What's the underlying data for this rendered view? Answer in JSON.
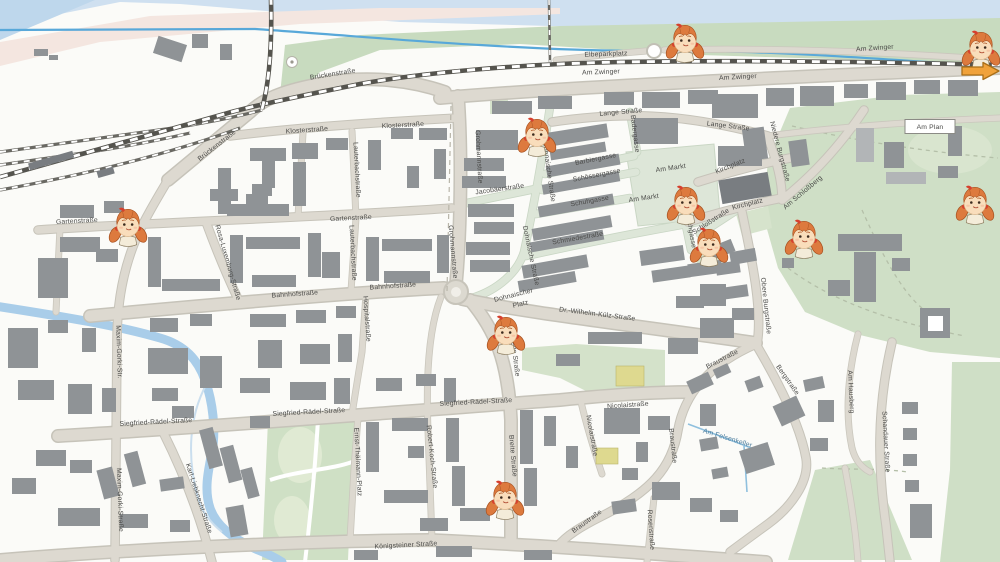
{
  "map": {
    "colors": {
      "building": "#8f9396",
      "road": "#ddd9d0",
      "pedestrian_zone": "#dde6d8",
      "park": "#cfdfc6",
      "riverbank_meadow": "#c8dbbf",
      "water_line": "#58a8d9",
      "river": "#a9cde9",
      "railway": "#55544e",
      "mascot_hair": "#dd7a3e",
      "mascot_ribbon": "#d6402e",
      "arrow": "#f0a23a",
      "label_text": "#4a4a48"
    },
    "street_labels": [
      {
        "t": "Brückenstraße",
        "x": 218,
        "y": 147,
        "r": -38
      },
      {
        "t": "Brückenstraße",
        "x": 333,
        "y": 76,
        "r": -9
      },
      {
        "t": "Klosterstraße",
        "x": 307,
        "y": 132,
        "r": -4
      },
      {
        "t": "Klosterstraße",
        "x": 403,
        "y": 127,
        "r": -3
      },
      {
        "t": "Elbeparkplatz",
        "x": 606,
        "y": 56,
        "r": -2
      },
      {
        "t": "Am Zwinger",
        "x": 601,
        "y": 74,
        "r": -2
      },
      {
        "t": "Am Zwinger",
        "x": 738,
        "y": 79,
        "r": -3
      },
      {
        "t": "Am Zwinger",
        "x": 875,
        "y": 50,
        "r": -4
      },
      {
        "t": "Lange Straße",
        "x": 621,
        "y": 114,
        "r": -5
      },
      {
        "t": "Lange Straße",
        "x": 728,
        "y": 128,
        "r": 7
      },
      {
        "t": "Am Plan",
        "x": 930,
        "y": 129,
        "r": 0,
        "b": 1
      },
      {
        "t": "Kirchplatz",
        "x": 731,
        "y": 168,
        "r": -22
      },
      {
        "t": "Kirchplatz",
        "x": 748,
        "y": 206,
        "r": -14
      },
      {
        "t": "Niedere Burgstraße",
        "x": 778,
        "y": 152,
        "r": 75
      },
      {
        "t": "Badergasse",
        "x": 633,
        "y": 134,
        "r": 83
      },
      {
        "t": "Barbiergasse",
        "x": 596,
        "y": 161,
        "r": -11
      },
      {
        "t": "Schössergasse",
        "x": 597,
        "y": 177,
        "r": -11
      },
      {
        "t": "Schuhgasse",
        "x": 590,
        "y": 203,
        "r": -10
      },
      {
        "t": "Am Markt",
        "x": 671,
        "y": 170,
        "r": -8
      },
      {
        "t": "Am Markt",
        "x": 644,
        "y": 200,
        "r": -8
      },
      {
        "t": "Jacobäerstraße",
        "x": 500,
        "y": 191,
        "r": -8
      },
      {
        "t": "Schmiedestraße",
        "x": 578,
        "y": 240,
        "r": -10
      },
      {
        "t": "Schloßstraße",
        "x": 712,
        "y": 223,
        "r": -33
      },
      {
        "t": "Kirchgasse",
        "x": 689,
        "y": 231,
        "r": 80
      },
      {
        "t": "Am Schloßberg",
        "x": 804,
        "y": 194,
        "r": -40
      },
      {
        "t": "Obere Burgstraße",
        "x": 764,
        "y": 306,
        "r": 84
      },
      {
        "t": "Dohnaische Straße",
        "x": 547,
        "y": 172,
        "r": 82
      },
      {
        "t": "Dohnaische Straße",
        "x": 529,
        "y": 256,
        "r": 78
      },
      {
        "t": "Grohmannstraße",
        "x": 477,
        "y": 157,
        "r": 87
      },
      {
        "t": "Grohmannstraße",
        "x": 451,
        "y": 252,
        "r": 85
      },
      {
        "t": "Gartenstraße",
        "x": 77,
        "y": 223,
        "r": -3
      },
      {
        "t": "Gartenstraße",
        "x": 351,
        "y": 220,
        "r": -3
      },
      {
        "t": "Lauterbachstraße",
        "x": 355,
        "y": 170,
        "r": 87
      },
      {
        "t": "Lauterbachstraße",
        "x": 351,
        "y": 253,
        "r": 87
      },
      {
        "t": "Rosa-Luxemburg-Straße",
        "x": 226,
        "y": 263,
        "r": 74
      },
      {
        "t": "Bahnhofstraße",
        "x": 295,
        "y": 296,
        "r": -4
      },
      {
        "t": "Bahnhofstraße",
        "x": 393,
        "y": 288,
        "r": -4
      },
      {
        "t": "Hospitalstraße",
        "x": 365,
        "y": 319,
        "r": 86
      },
      {
        "t": "Maxim-Gorki-Str.",
        "x": 117,
        "y": 352,
        "r": 88
      },
      {
        "t": "Maxim-Gorki-Straße",
        "x": 118,
        "y": 500,
        "r": 88
      },
      {
        "t": "Dohnaischer",
        "x": 514,
        "y": 297,
        "r": -14
      },
      {
        "t": "Platz",
        "x": 521,
        "y": 306,
        "r": -14
      },
      {
        "t": "Dr.-Wilhelm-Külz-Straße",
        "x": 597,
        "y": 316,
        "r": 7
      },
      {
        "t": "Breite Straße",
        "x": 513,
        "y": 356,
        "r": 83
      },
      {
        "t": "Breite Straße",
        "x": 511,
        "y": 456,
        "r": 85
      },
      {
        "t": "Siegfried-Rädel-Straße",
        "x": 156,
        "y": 424,
        "r": -3
      },
      {
        "t": "Siegfried-Rädel-Straße",
        "x": 309,
        "y": 414,
        "r": -3
      },
      {
        "t": "Siegfried-Rädel-Straße",
        "x": 476,
        "y": 404,
        "r": -3
      },
      {
        "t": "Nicolaistraße",
        "x": 628,
        "y": 407,
        "r": -4
      },
      {
        "t": "Nicolaistraße",
        "x": 590,
        "y": 436,
        "r": 80
      },
      {
        "t": "Robert-Koch-Straße",
        "x": 430,
        "y": 457,
        "r": 84
      },
      {
        "t": "Karl-Liebknecht-Straße",
        "x": 197,
        "y": 499,
        "r": 72
      },
      {
        "t": "Ernst-Thälmann-Platz",
        "x": 356,
        "y": 462,
        "r": 87
      },
      {
        "t": "Königsteiner Straße",
        "x": 406,
        "y": 547,
        "r": -3
      },
      {
        "t": "Braustraße",
        "x": 723,
        "y": 361,
        "r": -27
      },
      {
        "t": "Braustraße",
        "x": 671,
        "y": 446,
        "r": 84
      },
      {
        "t": "Braustraße",
        "x": 588,
        "y": 523,
        "r": -36
      },
      {
        "t": "Rosenstraße",
        "x": 649,
        "y": 530,
        "r": 86
      },
      {
        "t": "Bergstraße",
        "x": 786,
        "y": 381,
        "r": 55
      },
      {
        "t": "Am Hausberg",
        "x": 849,
        "y": 392,
        "r": 87
      },
      {
        "t": "Schandauer Straße",
        "x": 884,
        "y": 442,
        "r": 87
      },
      {
        "t": "Am Felsenkeller",
        "x": 727,
        "y": 440,
        "r": 17,
        "c": "w"
      }
    ],
    "mascots": [
      {
        "x": 537,
        "y": 140
      },
      {
        "x": 686,
        "y": 208
      },
      {
        "x": 709,
        "y": 250
      },
      {
        "x": 804,
        "y": 242
      },
      {
        "x": 975,
        "y": 208
      },
      {
        "x": 685,
        "y": 46
      },
      {
        "x": 981,
        "y": 53
      },
      {
        "x": 128,
        "y": 230
      },
      {
        "x": 506,
        "y": 338
      },
      {
        "x": 505,
        "y": 503
      }
    ],
    "arrow": {
      "x": 980,
      "y": 71,
      "direction": "right"
    },
    "icons": {
      "mascot": "girl-with-pigtails-marker",
      "arrow": "orange-right-arrow"
    }
  }
}
